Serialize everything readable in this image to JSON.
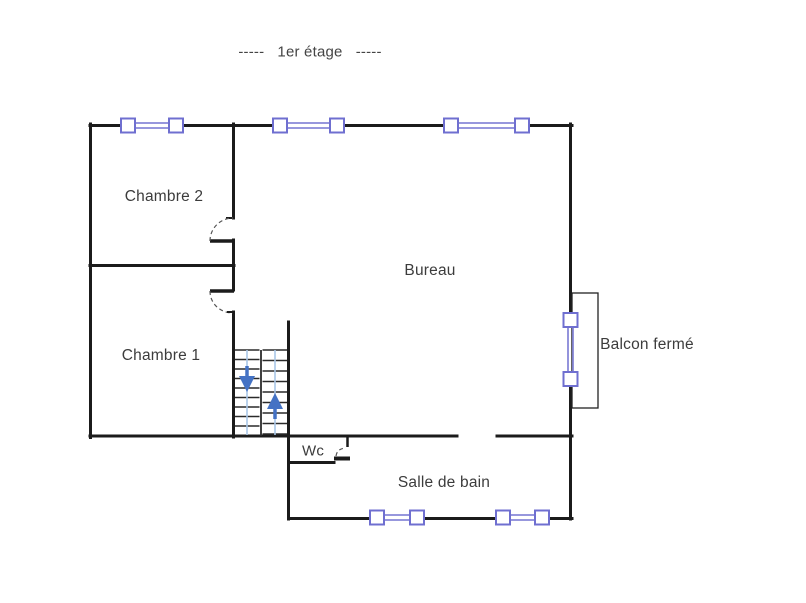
{
  "title": "-----   1er étage   -----",
  "rooms": {
    "chambre2": {
      "label": "Chambre 2"
    },
    "chambre1": {
      "label": "Chambre 1"
    },
    "bureau": {
      "label": "Bureau"
    },
    "balcon": {
      "label": "Balcon fermé"
    },
    "wc": {
      "label": "Wc"
    },
    "salle_de_bain": {
      "label": "Salle de bain"
    }
  },
  "colors": {
    "wall": "#1b1b1b",
    "window": "#6f6fd0",
    "window_line": "#8888d8",
    "arrow": "#4472c4",
    "stair_guide": "#a9c7e8",
    "text": "#3c3c3c"
  }
}
